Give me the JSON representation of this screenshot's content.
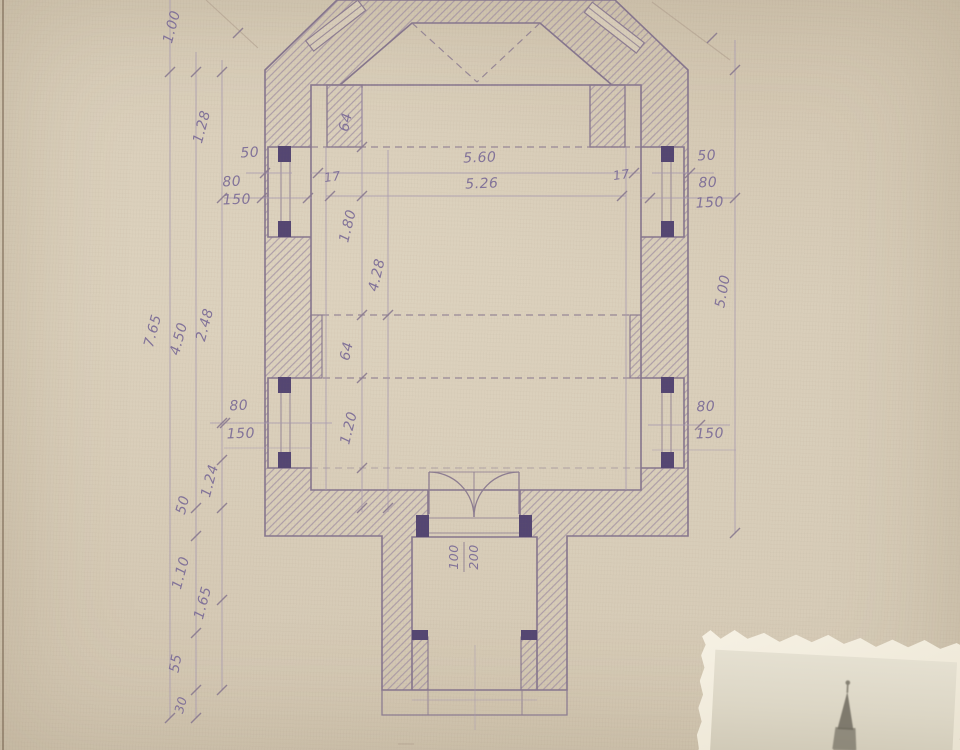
{
  "document": {
    "kind": "architectural floor plan, hand drawn ink on aged paper"
  },
  "colors": {
    "paper": "#d6cbb7",
    "ink": "#8d7d92",
    "handwriting": "#7b6c98",
    "jamb_dark": "#544672",
    "pencil": "#b5a694"
  },
  "dimensions": {
    "left_chain": {
      "top": "1.00",
      "upper": "1.28",
      "overall": "7.65",
      "nave": "4.50",
      "mid": "2.48",
      "fifty": "50",
      "bay": "1.24",
      "lower": "1.10",
      "porch": "1.65",
      "step": "55",
      "base": "30"
    },
    "left_upper_wall": {
      "a": "50",
      "b": "80",
      "c": "150"
    },
    "left_lower_wall": {
      "a": "80",
      "b": "150"
    },
    "right_upper_wall": {
      "a": "50",
      "b": "80",
      "c": "150"
    },
    "right_lower_wall": {
      "a": "80",
      "b": "150"
    },
    "right_chain": {
      "overall": "5.00"
    },
    "interior": {
      "chancel_depth": "64",
      "nave_width": "5.60",
      "nave_width_inner": "5.26",
      "pier_left": "17",
      "pier_right": "17",
      "bay_upper": "1.80",
      "nave_length": "4.28",
      "pier_depth": "64",
      "bay_lower": "1.20"
    },
    "door": {
      "width": "100",
      "height": "200"
    }
  },
  "photo": {
    "subject": "church spire photograph"
  }
}
